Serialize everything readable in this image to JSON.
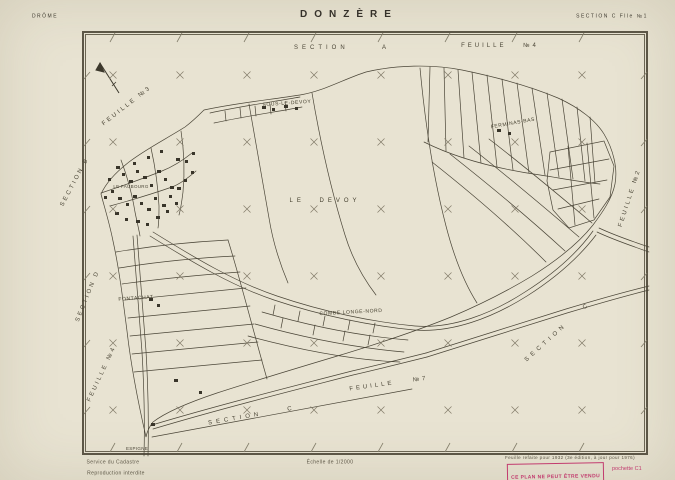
{
  "header": {
    "department": "DRÔME",
    "title": "DONZÈRE",
    "sheet_ref": "SECTION C Flle №1"
  },
  "margins": {
    "top_section": "SECTION A",
    "top_feuille": "FEUILLE №4",
    "topleft_feuille": "FEUILLE №3",
    "left_section": "SECTION B",
    "left_section_lower": "SECTION D",
    "bottomleft_feuille": "FEUILLE №4",
    "bottom_section": "SECTION C",
    "bottom_feuille": "FEUILLE №7",
    "right_feuille": "FEUILLE №2",
    "bottomright_section": "SECTION C"
  },
  "places": {
    "sous_le_devoy": "SOUS-LE-DEVOY",
    "ferminas_bas": "FERMINAS-BAS",
    "le_devoy": "LE DEVOY",
    "le_faubourg": "LE FAUBOURG",
    "fontachat": "FONTACHAT",
    "combe_longe_nord": "COMBE LONGE-NORD",
    "espigne": "ESPIGNE"
  },
  "footer": {
    "service": "Service du Cadastre",
    "reproduction": "Reproduction interdite",
    "scale": "Échelle de 1/2000",
    "revision_note": "Feuille refaite pour 1932 (3e édition, à jour pour 1976)",
    "stamp": "CE PLAN NE PEUT ÊTRE VENDU",
    "pochette": "pochette C1"
  },
  "colors": {
    "paper": "#e8e3d2",
    "ink": "#4a4537",
    "grid": "#837d6a",
    "stamp": "#c23b6e"
  }
}
